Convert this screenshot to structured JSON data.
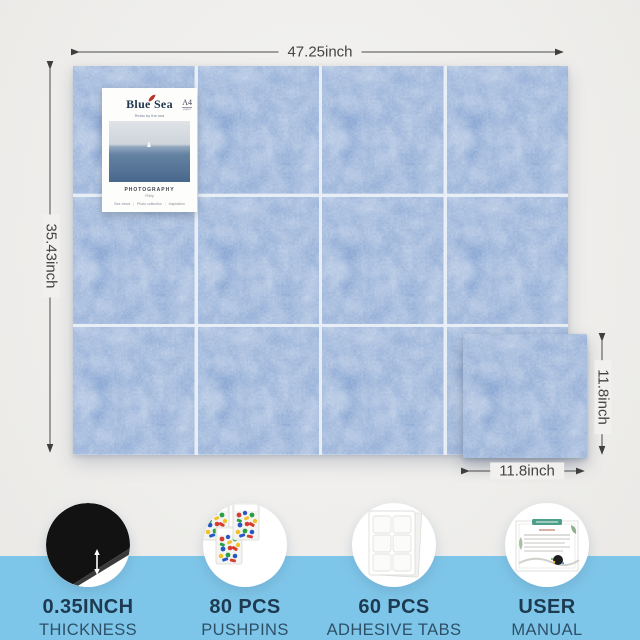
{
  "dims": {
    "board_width": "47.25inch",
    "board_height": "35.43inch",
    "tile_height": "11.8inch",
    "tile_width": "11.8inch"
  },
  "board": {
    "columns": 4,
    "rows": 3,
    "tiles_shown": 12
  },
  "poster": {
    "title": "Blue Sea",
    "subtitle": "Relax by the sea",
    "corner_badge": "A4",
    "corner_badge_sub": "paper",
    "caption": "PHOTOGRAPHY",
    "caption_sub": "Philip",
    "footer_items": [
      "Sea views",
      "Photo collection",
      "Inspiration"
    ]
  },
  "features": [
    {
      "icon": "thickness-icon",
      "line1": "0.35INCH",
      "line2": "THICKNESS"
    },
    {
      "icon": "pushpins-icon",
      "line1": "80 PCS",
      "line2": "PUSHPINS"
    },
    {
      "icon": "adhesive-tabs-icon",
      "line1": "60 PCS",
      "line2": "ADHESIVE TABS"
    },
    {
      "icon": "user-manual-icon",
      "line1": "USER",
      "line2": "MANUAL"
    }
  ],
  "colors": {
    "band_blue": "#7ec6e9",
    "felt_blue": "#87a5d2",
    "text_navy": "#1d3a50"
  }
}
